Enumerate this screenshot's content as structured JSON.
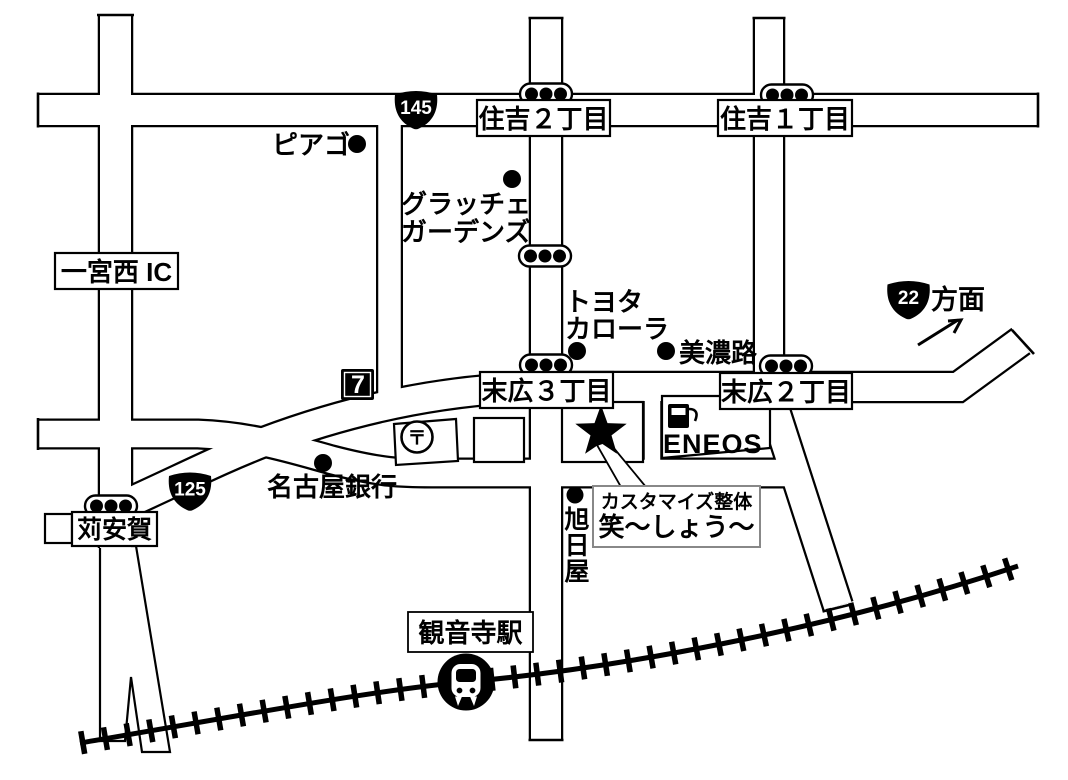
{
  "map": {
    "title_hint": "access-map",
    "intersections": {
      "sumiyoshi2": "住吉２丁目",
      "sumiyoshi1": "住吉１丁目",
      "suehiro3": "末広３丁目",
      "suehiro2": "末広２丁目",
      "kariyasuka": "苅安賀"
    },
    "routes": {
      "route145": "145",
      "route125": "125",
      "route22": "22",
      "route22_direction": "方面"
    },
    "landmarks": {
      "piago": "ピアゴ",
      "gratche_line1": "グラッチェ",
      "gratche_line2": "ガーデンズ",
      "ichinomiya_ic": "一宮西 IC",
      "toyota_line1": "トヨタ",
      "toyota_line2": "カローラ",
      "minoji": "美濃路",
      "nagoya_bank": "名古屋銀行",
      "eneos": "ENEOS",
      "seven_eleven": "7",
      "post_office_mark": "〒",
      "asahiya_char1": "旭",
      "asahiya_char2": "日",
      "asahiya_char3": "屋",
      "station": "観音寺駅"
    },
    "destination": {
      "line1": "カスタマイズ整体",
      "line2": "笑～しょう～"
    },
    "colors": {
      "road_outline": "#000000",
      "road_fill": "#ffffff",
      "badge_fill": "#000000",
      "destination_border": "#888888"
    }
  }
}
